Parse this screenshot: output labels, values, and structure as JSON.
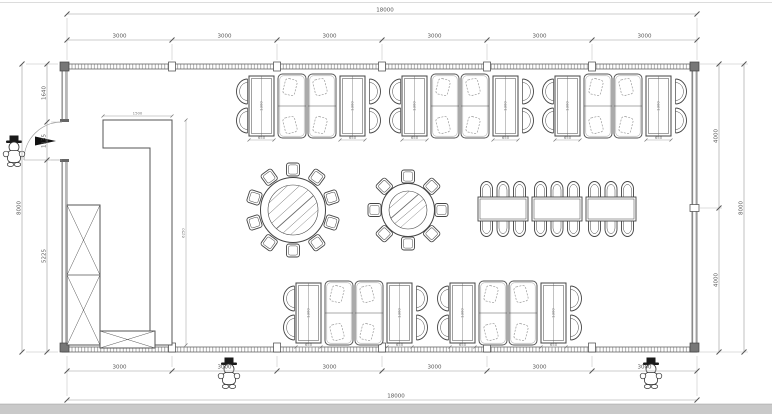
{
  "plan": {
    "dims": {
      "top": {
        "total": "18000",
        "segments": [
          "3000",
          "3000",
          "3000",
          "3000",
          "3000",
          "3000"
        ]
      },
      "bottom": {
        "total": "18000",
        "segments": [
          "3000",
          "3000",
          "3000",
          "3000",
          "3000",
          "3000"
        ]
      },
      "left": {
        "total": "8000",
        "segments": [
          "1640",
          "1135",
          "5225"
        ]
      },
      "right": {
        "total": "8000",
        "segments": [
          "4000",
          "4000"
        ]
      },
      "counter": {
        "width": "1500",
        "height": "6250"
      },
      "booth": {
        "table_width": "650",
        "table_length": "1300"
      }
    },
    "inventory": {
      "booth_groups_top": 3,
      "booth_groups_bottom": 2,
      "round_table_large_seats": 10,
      "round_table_small_seats": 8,
      "long_table_sections": 3,
      "long_table_seats": 18,
      "mascot_figures": 3,
      "entrance_doors": 1
    },
    "colors": {
      "line": "#444444",
      "wall": "#8a8a8a",
      "dim_line": "#999999",
      "dim_text": "#555555",
      "fill": "#ffffff",
      "bottom_band": "#c9c9c9"
    }
  }
}
